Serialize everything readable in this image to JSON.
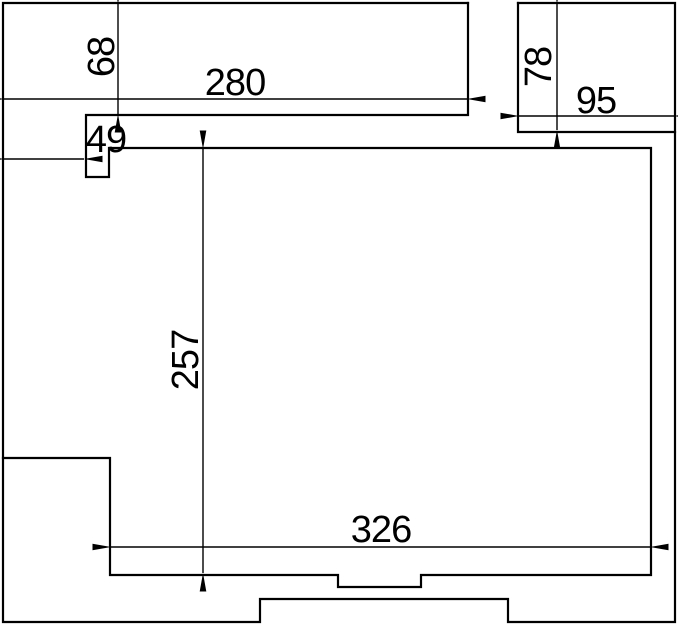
{
  "drawing": {
    "kind": "dimensioned-outline-technical-drawing",
    "colors": {
      "line": "#000000",
      "background": "#ffffff",
      "text": "#000000"
    },
    "dimensions": [
      {
        "id": "dim-68",
        "label": "68",
        "orientation": "vertical",
        "location": "top-left"
      },
      {
        "id": "dim-280",
        "label": "280",
        "orientation": "horizontal",
        "location": "top"
      },
      {
        "id": "dim-49",
        "label": "49",
        "orientation": "horizontal",
        "location": "upper-left"
      },
      {
        "id": "dim-78",
        "label": "78",
        "orientation": "vertical",
        "location": "top-right"
      },
      {
        "id": "dim-95",
        "label": "95",
        "orientation": "horizontal",
        "location": "top-right"
      },
      {
        "id": "dim-257",
        "label": "257",
        "orientation": "vertical",
        "location": "center"
      },
      {
        "id": "dim-326",
        "label": "326",
        "orientation": "horizontal",
        "location": "bottom"
      }
    ]
  }
}
